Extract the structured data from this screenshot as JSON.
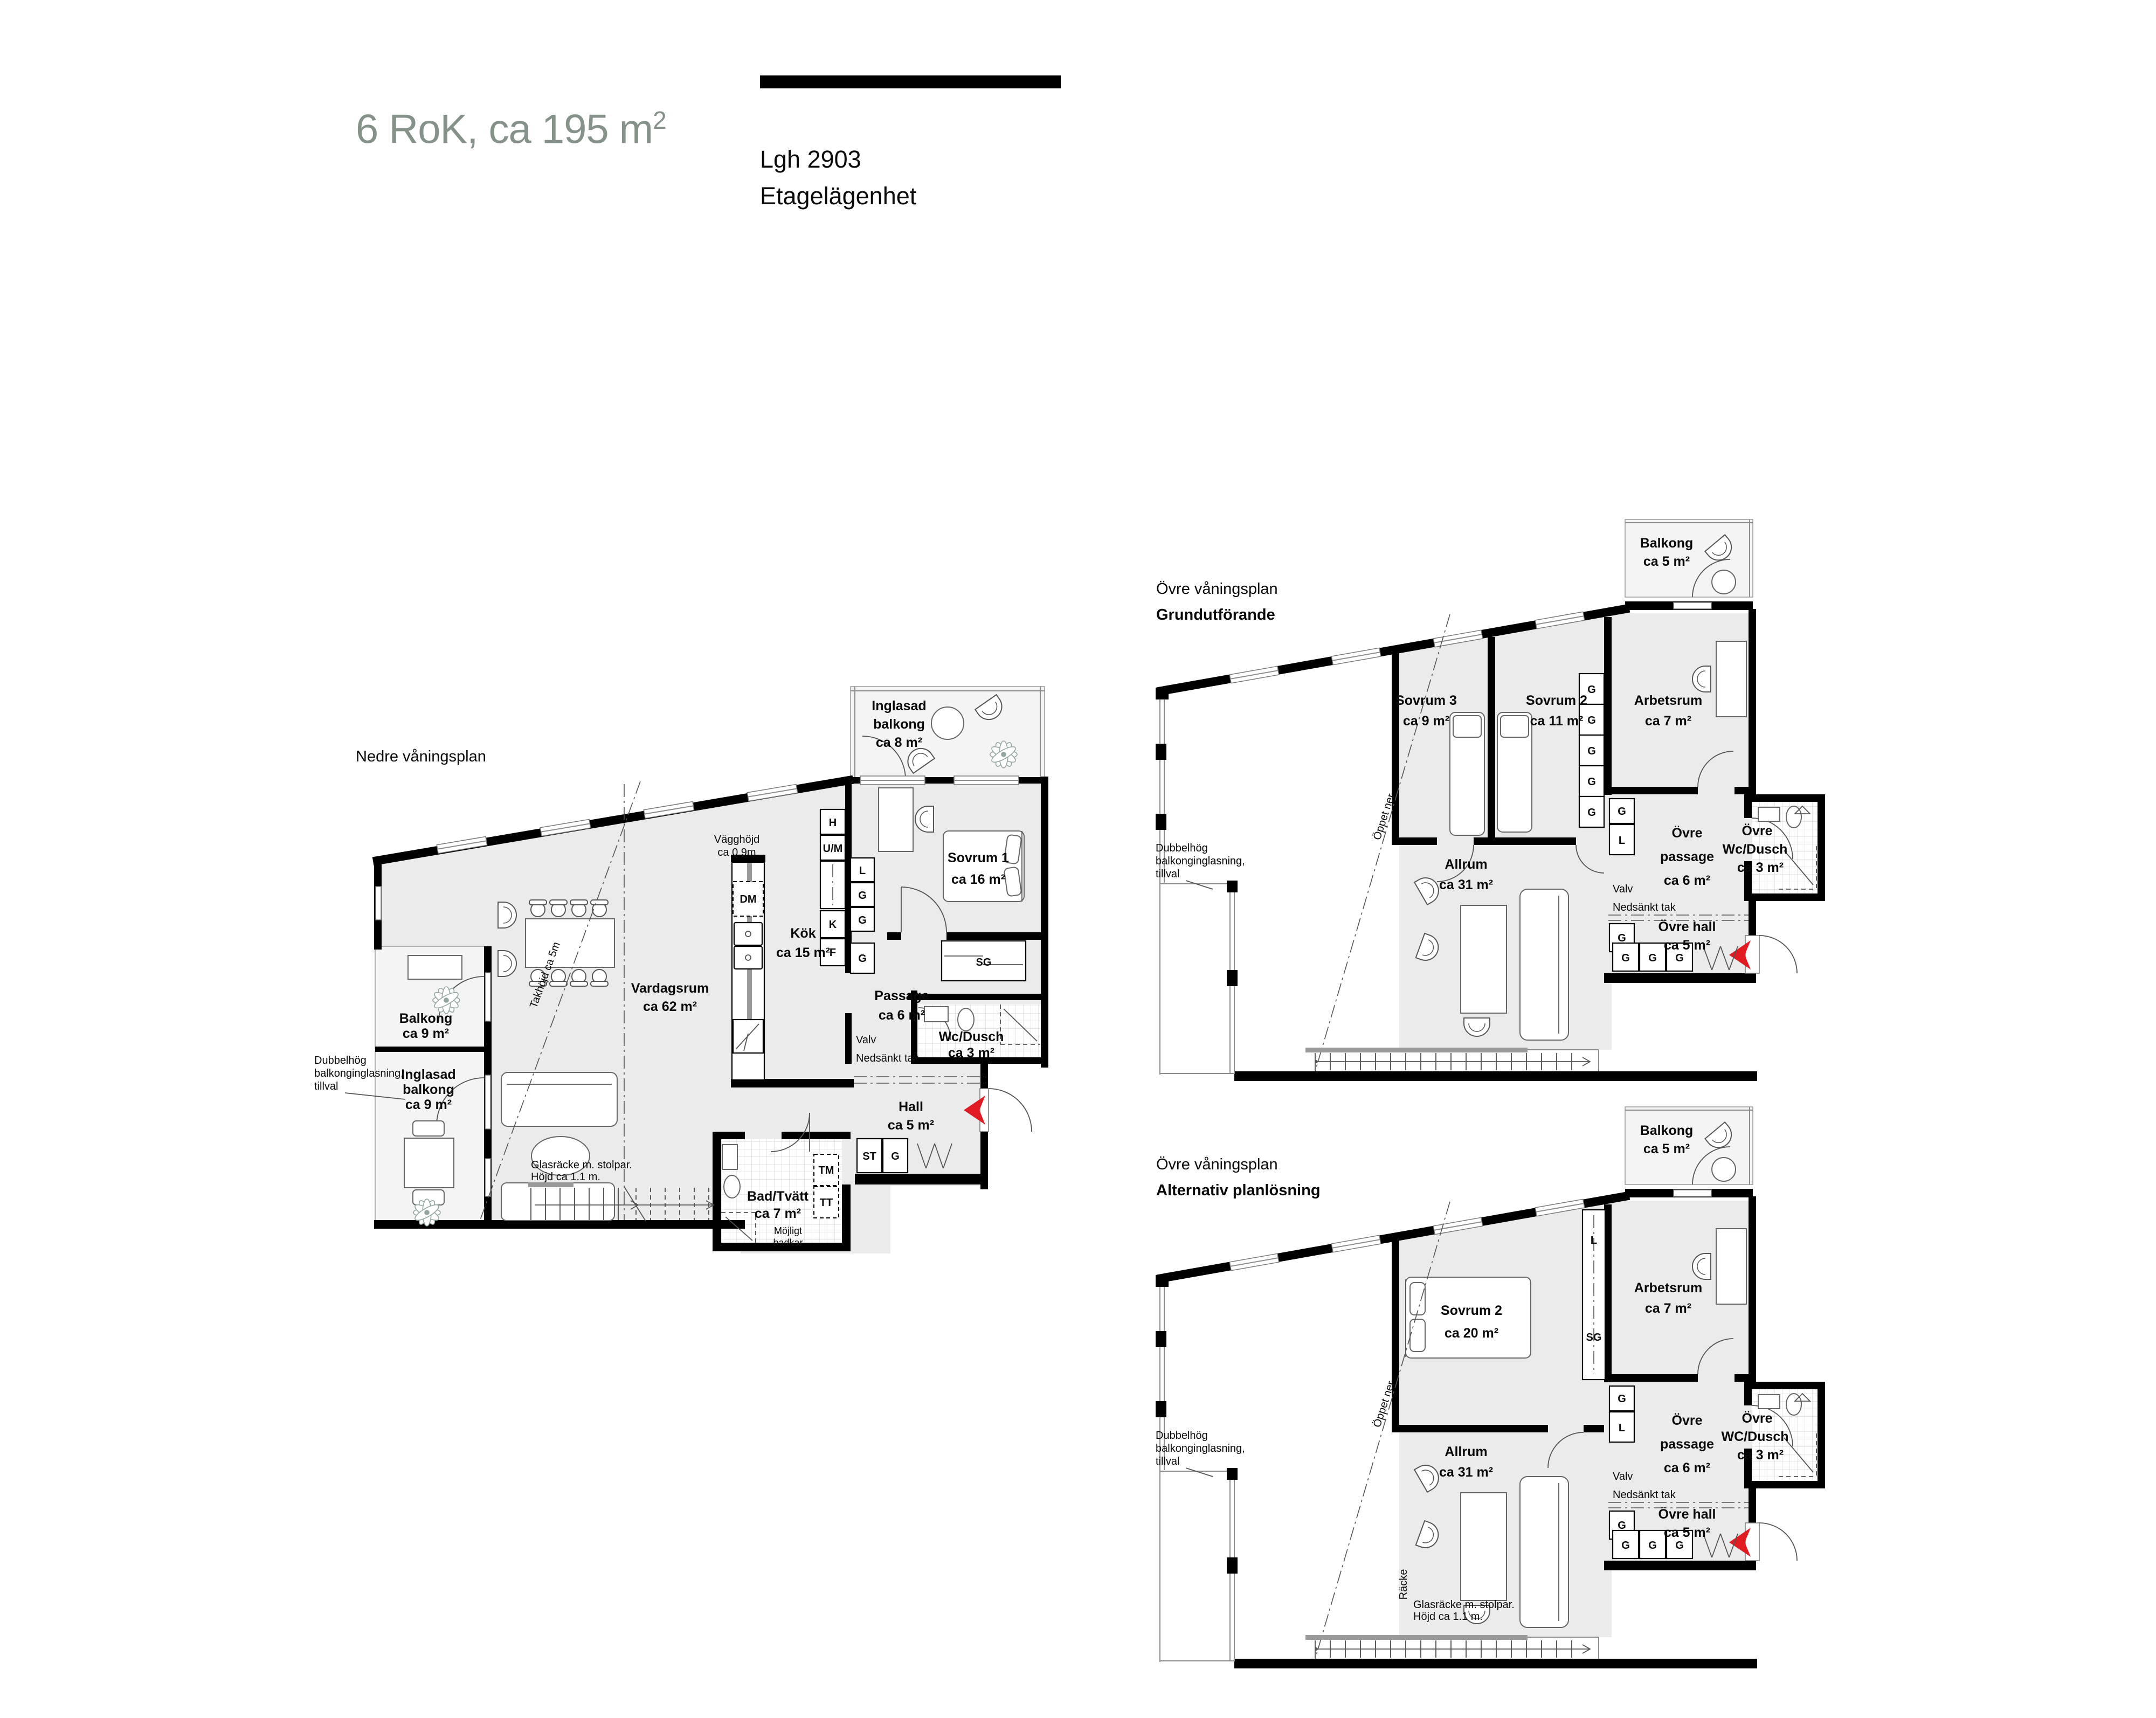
{
  "header": {
    "title": "6 RoK, ca 195 m",
    "title_sup": "2",
    "apartment": "Lgh 2903",
    "apartment_type": "Etagelägenhet"
  },
  "colors": {
    "title_accent": "#859289",
    "wall": "#000000",
    "room_fill": "#ebebeb",
    "balcony_fill": "#f4f4f4",
    "entry_arrow": "#e11b22",
    "plant": "#93a69d"
  },
  "plan_lower": {
    "title": "Nedre våningsplan",
    "rooms": {
      "inglasad_balkong_top": {
        "l1": "Inglasad",
        "l2": "balkong",
        "l3": "ca 8 m²"
      },
      "sovrum1": {
        "name": "Sovrum 1",
        "area": "ca 16 m²"
      },
      "kok": {
        "name": "Kök",
        "area": "ca 15 m²"
      },
      "vardagsrum": {
        "name": "Vardagsrum",
        "area": "ca 62 m²"
      },
      "passage": {
        "name": "Passage",
        "area": "ca 6 m²"
      },
      "wc_dusch": {
        "name": "Wc/Dusch",
        "area": "ca 3 m²"
      },
      "hall": {
        "name": "Hall",
        "area": "ca 5 m²"
      },
      "bad_tvatt": {
        "name": "Bad/Tvätt",
        "area": "ca 7 m²"
      },
      "balkong": {
        "name": "Balkong",
        "area": "ca 9 m²"
      },
      "inglasad_balkong_left": {
        "l1": "Inglasad",
        "l2": "balkong",
        "l3": "ca 9 m²"
      }
    },
    "annotations": {
      "vagghojd": {
        "l1": "Vägghöjd",
        "l2": "ca 0.9m"
      },
      "takhojd": "Takhöjd ca 5m",
      "valv": {
        "l1": "Valv",
        "l2": "Nedsänkt tak"
      },
      "mojligt_badkar": {
        "l1": "Möjligt",
        "l2": "badkar"
      },
      "dubbelhog": {
        "l1": "Dubbelhög",
        "l2": "balkonginglasning,",
        "l3": "tillval"
      },
      "glasracke": {
        "l1": "Glasräcke m. stolpar.",
        "l2": "Höjd ca 1.1 m."
      }
    },
    "closets": {
      "h": "H",
      "um": "U/M",
      "dm": "DM",
      "k": "K",
      "f": "F",
      "l": "L",
      "g": "G",
      "sg": "SG",
      "st": "ST",
      "tm": "TM",
      "tt": "TT"
    }
  },
  "plan_upper_main": {
    "title1": "Övre våningsplan",
    "title2": "Grundutförande",
    "rooms": {
      "balkong": {
        "l1": "Balkong",
        "l2": "ca 5 m²"
      },
      "sovrum3": {
        "name": "Sovrum 3",
        "area": "ca 9 m²"
      },
      "sovrum2": {
        "name": "Sovrum 2",
        "area": "ca 11 m²"
      },
      "arbetsrum": {
        "name": "Arbetsrum",
        "area": "ca 7 m²"
      },
      "allrum": {
        "name": "Allrum",
        "area": "ca 31 m²"
      },
      "passage": {
        "l1": "Övre",
        "l2": "passage",
        "l3": "ca 6 m²"
      },
      "wc": {
        "l1": "Övre",
        "l2": "Wc/Dusch",
        "l3": "ca 3 m²"
      },
      "hall": {
        "name": "Övre hall",
        "area": "ca 5 m²"
      }
    },
    "annotations": {
      "valv": {
        "l1": "Valv",
        "l2": "Nedsänkt tak"
      },
      "oppet_ner": "Öppet ner",
      "dubbelhog": {
        "l1": "Dubbelhög",
        "l2": "balkonginglasning,",
        "l3": "tillval"
      }
    },
    "closets": {
      "g": "G",
      "l": "L"
    }
  },
  "plan_upper_alt": {
    "title1": "Övre våningsplan",
    "title2": "Alternativ planlösning",
    "rooms": {
      "balkong": {
        "l1": "Balkong",
        "l2": "ca 5 m²"
      },
      "sovrum2": {
        "name": "Sovrum 2",
        "area": "ca 20 m²"
      },
      "arbetsrum": {
        "name": "Arbetsrum",
        "area": "ca 7 m²"
      },
      "allrum": {
        "name": "Allrum",
        "area": "ca 31 m²"
      },
      "passage": {
        "l1": "Övre",
        "l2": "passage",
        "l3": "ca 6 m²"
      },
      "wc": {
        "l1": "Övre",
        "l2": "WC/Dusch",
        "l3": "ca 3 m²"
      },
      "hall": {
        "name": "Övre hall",
        "area": "ca 5 m²"
      }
    },
    "annotations": {
      "valv": {
        "l1": "Valv",
        "l2": "Nedsänkt tak"
      },
      "oppet_ner": "Öppet ner",
      "racke": "Räcke",
      "glasracke": {
        "l1": "Glasräcke m. stolpar.",
        "l2": "Höjd ca 1.1 m."
      },
      "dubbelhog": {
        "l1": "Dubbelhög",
        "l2": "balkonginglasning,",
        "l3": "tillval"
      }
    },
    "closets": {
      "g": "G",
      "l": "L",
      "sg": "SG"
    }
  }
}
